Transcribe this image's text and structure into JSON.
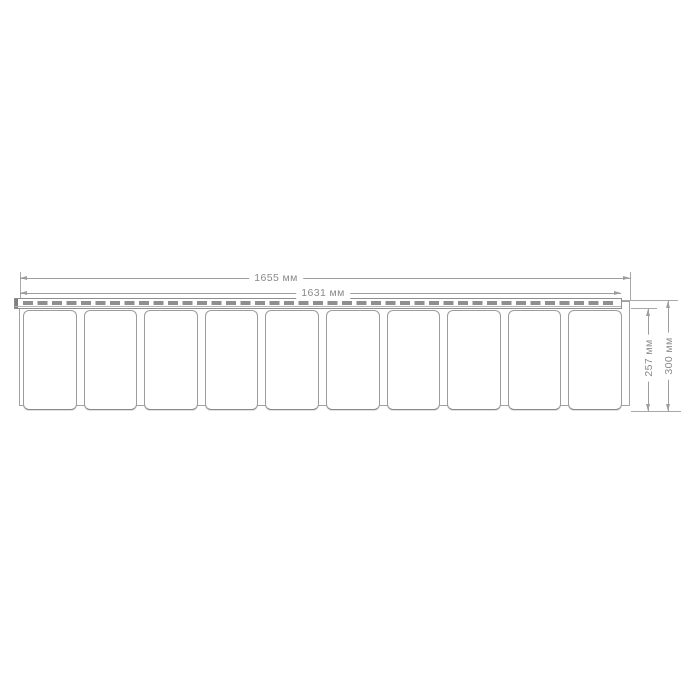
{
  "drawing": {
    "kind": "technical-dimension-drawing",
    "subject": "pvc-panel-profile",
    "panel_count": 10,
    "unit": "мм",
    "dimensions": {
      "overall_width": {
        "value": 1655,
        "label": "1655 мм"
      },
      "inner_width": {
        "value": 1631,
        "label": "1631 мм"
      },
      "panel_height": {
        "value": 257,
        "label": "257 мм"
      },
      "overall_height": {
        "value": 300,
        "label": "300 мм"
      }
    },
    "colors": {
      "background": "#ffffff",
      "outline": "#9c9c9c",
      "dimension_line": "#9d9d9d",
      "dimension_text": "#8a8a8a",
      "panel_fill": "#ffffff"
    }
  }
}
